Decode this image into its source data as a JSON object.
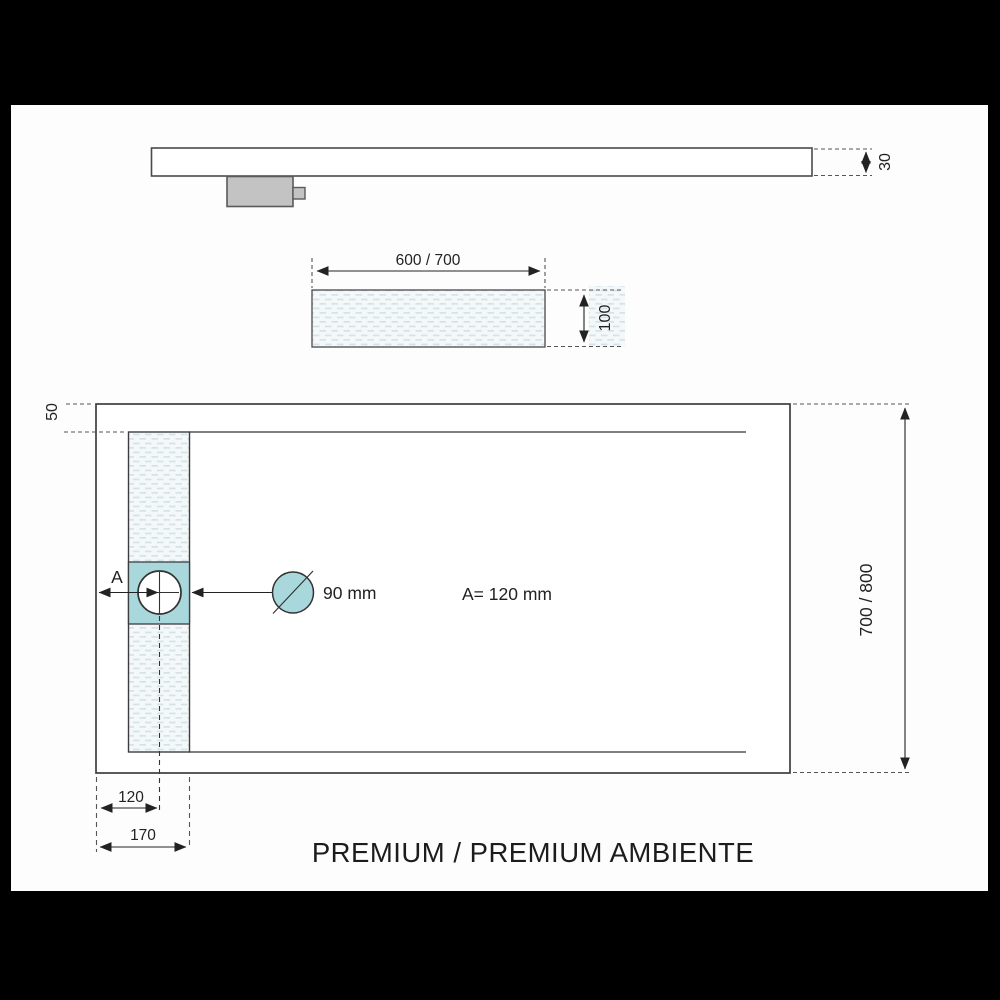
{
  "diagram": {
    "title": "PREMIUM / PREMIUM AMBIENTE",
    "side_view": {
      "name": "tray side elevation",
      "thickness_label": "30"
    },
    "channel_section": {
      "name": "drain channel section",
      "width_label": "600 / 700",
      "depth_label": "100"
    },
    "plan_view": {
      "name": "tray plan view",
      "edge_offset_label": "50",
      "length_label": "700  /  800",
      "length_label_display": "700 / 800",
      "drain_axis_label": "A",
      "drain_diameter_label": "90 mm",
      "drain_distance_note": "A= 120 mm",
      "drain_center_offset_label": "120",
      "channel_strip_offset_label": "170"
    },
    "colors": {
      "frame": "#000000",
      "paper": "#fdfdfd",
      "outline": "#4a4a4a",
      "dimension_line": "#222222",
      "teal_fill": "#a9d8dc",
      "drain_box_gray": "#c3c3c3",
      "hatch_background": "#f4f8f9",
      "hatch_dash": "#d3e3e9"
    }
  }
}
